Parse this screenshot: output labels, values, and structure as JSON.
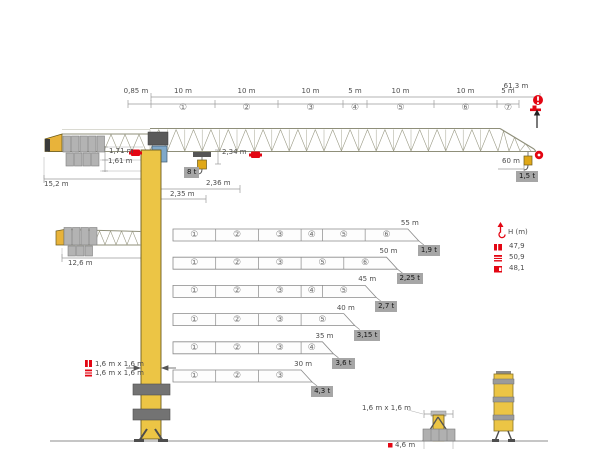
{
  "diagram": {
    "title_hint": "tower-crane-dimension-diagram",
    "top_dims": {
      "overall": "61,3 m",
      "offset": "0,85 m",
      "segments": [
        {
          "no": "①",
          "len": "10 m"
        },
        {
          "no": "②",
          "len": "10 m"
        },
        {
          "no": "③",
          "len": "10 m"
        },
        {
          "no": "④",
          "len": "5 m"
        },
        {
          "no": "⑤",
          "len": "10 m"
        },
        {
          "no": "⑥",
          "len": "10 m"
        },
        {
          "no": "⑦",
          "len": "5 m"
        }
      ]
    },
    "left_dims": {
      "jib_height": "1,71 m",
      "cab_height": "1,61 m",
      "counterjib_radius": "15,2 m",
      "counterjib_radius_short": "12,6 m"
    },
    "mast_dims": {
      "trolley_height": "2,34 m",
      "hook_reach_b": "2,36 m",
      "hook_reach_a": "2,35 m"
    },
    "max_load": "8 t",
    "tip": {
      "radius": "60 m",
      "load": "1,5 t"
    },
    "jib_configs": [
      {
        "length": "55 m",
        "tip_load": "1,9 t",
        "segments": [
          "①",
          "②",
          "③",
          "④",
          "⑤",
          "⑥"
        ]
      },
      {
        "length": "50 m",
        "tip_load": "2,25 t",
        "segments": [
          "①",
          "②",
          "③",
          "⑤",
          "⑥"
        ]
      },
      {
        "length": "45 m",
        "tip_load": "2,7 t",
        "segments": [
          "①",
          "②",
          "③",
          "④",
          "⑤"
        ]
      },
      {
        "length": "40 m",
        "tip_load": "3,15 t",
        "segments": [
          "①",
          "②",
          "③",
          "⑤"
        ]
      },
      {
        "length": "35 m",
        "tip_load": "3,6 t",
        "segments": [
          "①",
          "②",
          "③",
          "④"
        ]
      },
      {
        "length": "30 m",
        "tip_load": "4,3 t",
        "segments": [
          "①",
          "②",
          "③"
        ]
      }
    ],
    "height_table": {
      "header": "H (m)",
      "rows": [
        {
          "icon": "mast-solid-icon",
          "value": "47,9"
        },
        {
          "icon": "mast-striped-icon",
          "value": "50,9"
        },
        {
          "icon": "mast-notched-icon",
          "value": "48,1"
        }
      ]
    },
    "mast_legend": [
      {
        "icon": "mast-solid-icon",
        "label": "1,6 m x 1,6 m"
      },
      {
        "icon": "mast-striped-icon",
        "label": "1,6 m x 1,6 m"
      }
    ],
    "base": {
      "footprint": "1,6 m x 1,6 m",
      "below_ground": "4,6 m"
    },
    "icons": {
      "info-icon": "red circle with white exclamation",
      "hook-height-icon": "red hook with up arrow",
      "trolley-icon": "red trolley/load marker on jib",
      "hook-travel-arrow": "black arrow up",
      "tip-load-icon": "red circle with white dot"
    },
    "colors": {
      "red": "#e30613",
      "crane_yellow": "#ecc545",
      "gray_box": "#a6a6a6",
      "line_gray": "#8c8c8c",
      "text_gray": "#4d4d4d"
    }
  }
}
